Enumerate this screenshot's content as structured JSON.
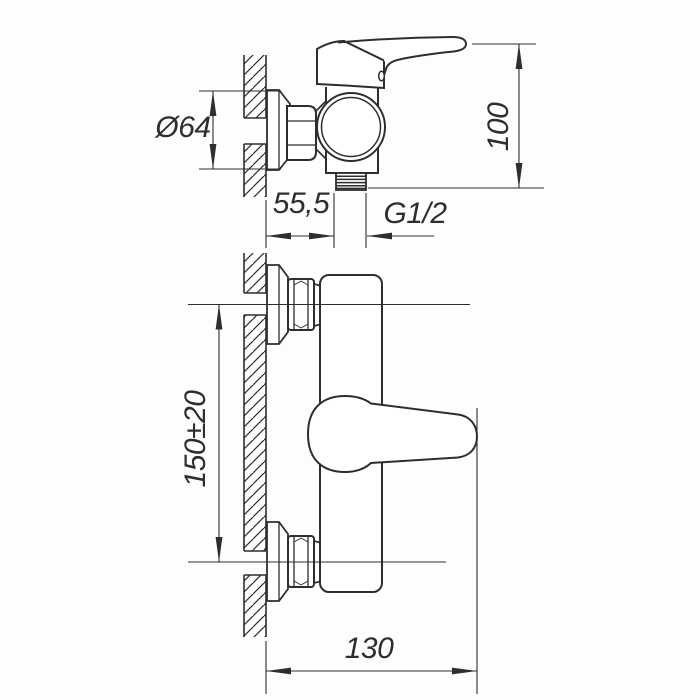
{
  "drawing": {
    "background_color": "#fdfdfd",
    "line_color": "#2e2e2e",
    "side_view": {
      "dim_flange_diameter": "Ø64",
      "dim_height": "100",
      "dim_wall_offset": "55,5",
      "thread_size_label": "G1/2"
    },
    "front_view": {
      "dim_connection_spacing": "150±20",
      "dim_overall_width": "130"
    }
  }
}
